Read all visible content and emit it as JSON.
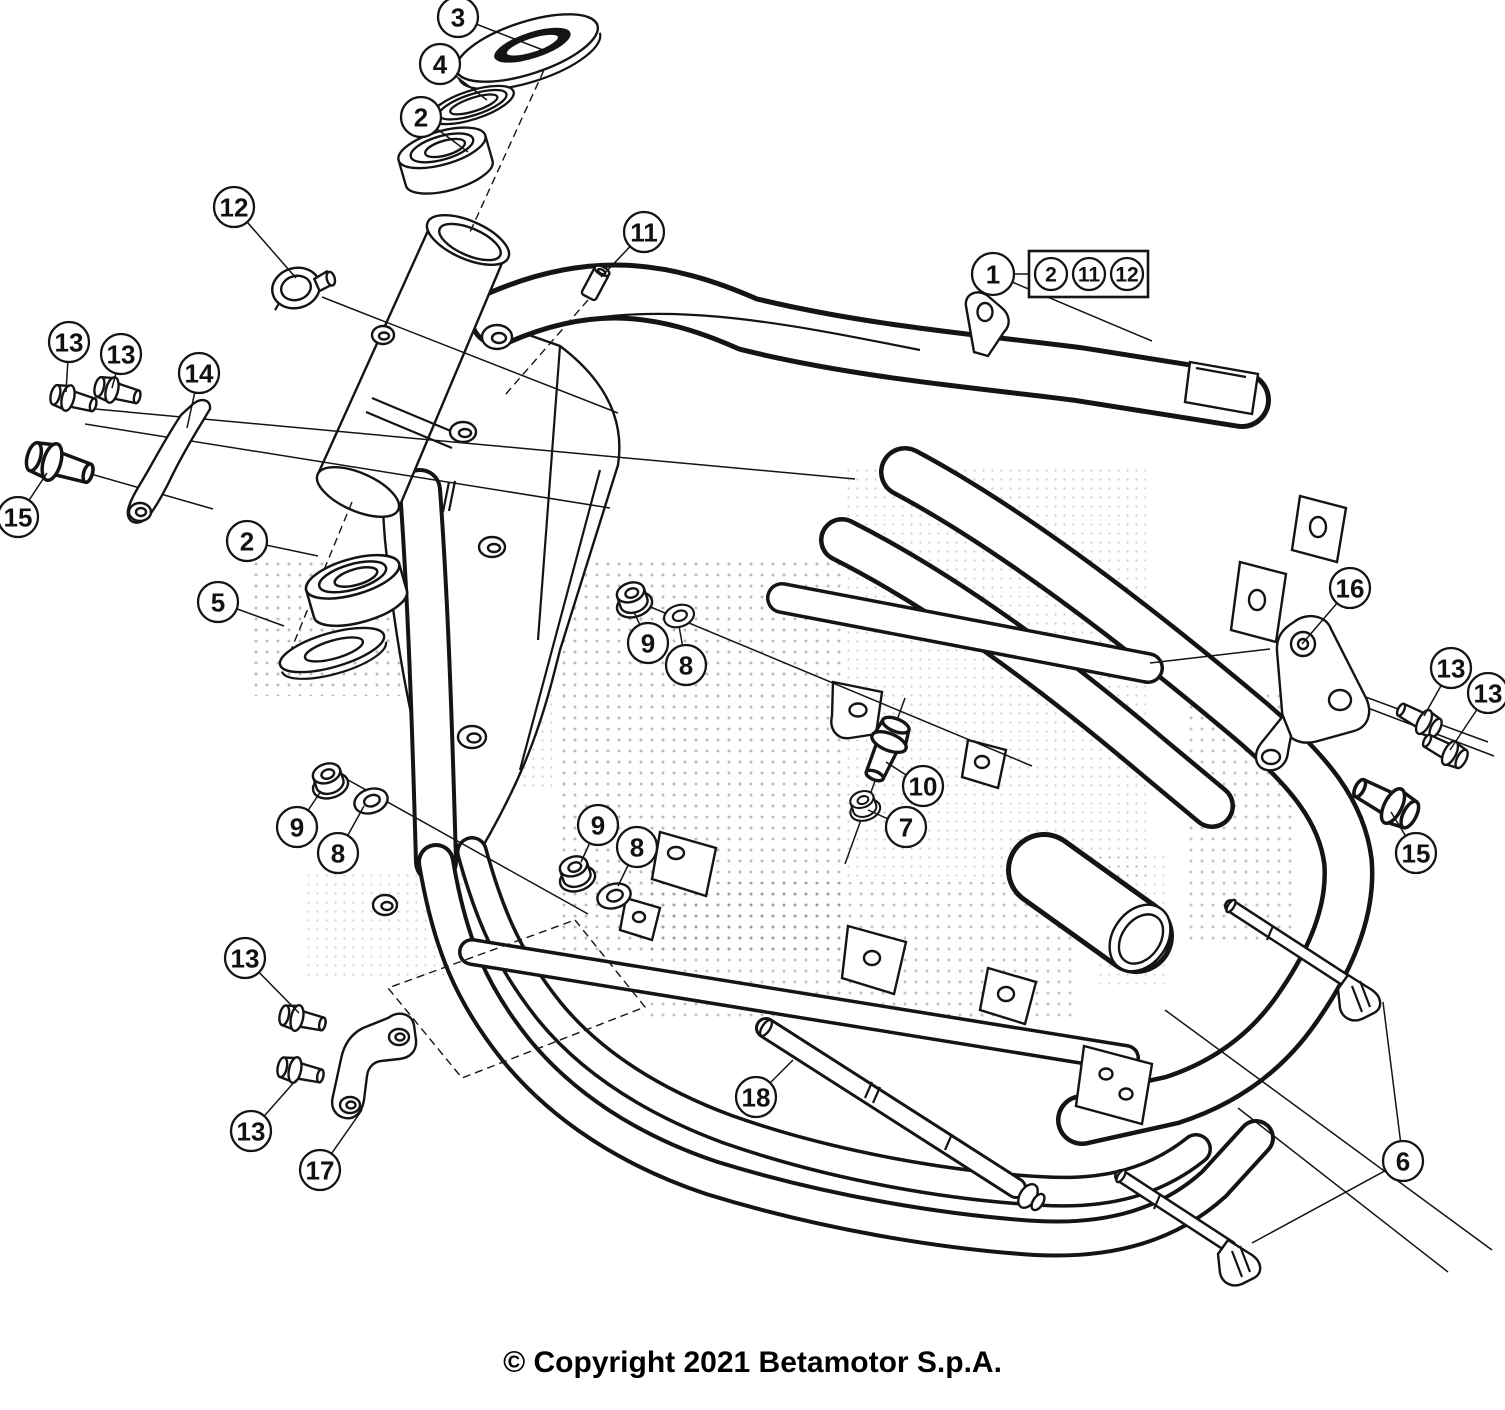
{
  "diagram": {
    "footer": {
      "copyright": "© Copyright 2021 Betamotor S.p.A."
    },
    "colors": {
      "line": "#141414",
      "background": "#ffffff",
      "halftone": "#80868d"
    },
    "bubble": {
      "radius": 20,
      "font_size": 26
    },
    "legend_box": {
      "lead": {
        "label": "1",
        "x": 993,
        "y": 274,
        "r": 21,
        "targets": [
          [
            1152,
            341
          ]
        ]
      },
      "connector": [
        1014,
        274,
        1029,
        274
      ],
      "box": {
        "x": 1029,
        "y": 251,
        "w": 119,
        "h": 46
      },
      "item_radius": 16,
      "item_font_size": 21,
      "items": [
        {
          "label": "2",
          "cx": 1051,
          "cy": 274
        },
        {
          "label": "11",
          "cx": 1089,
          "cy": 274
        },
        {
          "label": "12",
          "cx": 1127,
          "cy": 274
        }
      ]
    },
    "callouts": [
      {
        "label": "3",
        "x": 458,
        "y": 17,
        "targets": [
          [
            543,
            50
          ]
        ]
      },
      {
        "label": "4",
        "x": 440,
        "y": 64,
        "targets": [
          [
            487,
            100
          ]
        ]
      },
      {
        "label": "2",
        "x": 421,
        "y": 117,
        "targets": [
          [
            468,
            152
          ]
        ]
      },
      {
        "label": "12",
        "x": 234,
        "y": 207,
        "targets": [
          [
            296,
            278
          ]
        ]
      },
      {
        "label": "11",
        "x": 644,
        "y": 232,
        "targets": [
          [
            601,
            277
          ]
        ]
      },
      {
        "label": "13",
        "x": 69,
        "y": 342,
        "targets": [
          [
            66,
            392
          ]
        ]
      },
      {
        "label": "13",
        "x": 121,
        "y": 354,
        "targets": [
          [
            112,
            388
          ]
        ]
      },
      {
        "label": "14",
        "x": 199,
        "y": 373,
        "targets": [
          [
            187,
            428
          ]
        ]
      },
      {
        "label": "15",
        "x": 18,
        "y": 517,
        "targets": [
          [
            47,
            473
          ]
        ]
      },
      {
        "label": "2",
        "x": 247,
        "y": 541,
        "targets": [
          [
            318,
            556
          ]
        ]
      },
      {
        "label": "5",
        "x": 218,
        "y": 602,
        "targets": [
          [
            284,
            626
          ]
        ]
      },
      {
        "label": "9",
        "x": 648,
        "y": 643,
        "targets": [
          [
            634,
            612
          ]
        ]
      },
      {
        "label": "8",
        "x": 686,
        "y": 665,
        "targets": [
          [
            679,
            626
          ]
        ]
      },
      {
        "label": "16",
        "x": 1350,
        "y": 588,
        "targets": [
          [
            1302,
            644
          ]
        ]
      },
      {
        "label": "13",
        "x": 1451,
        "y": 668,
        "targets": [
          [
            1424,
            716
          ]
        ]
      },
      {
        "label": "13",
        "x": 1488,
        "y": 693,
        "targets": [
          [
            1450,
            750
          ]
        ]
      },
      {
        "label": "10",
        "x": 923,
        "y": 786,
        "targets": [
          [
            886,
            762
          ]
        ]
      },
      {
        "label": "7",
        "x": 906,
        "y": 827,
        "targets": [
          [
            868,
            810
          ]
        ]
      },
      {
        "label": "9",
        "x": 297,
        "y": 827,
        "targets": [
          [
            321,
            791
          ]
        ]
      },
      {
        "label": "8",
        "x": 338,
        "y": 853,
        "targets": [
          [
            364,
            806
          ]
        ]
      },
      {
        "label": "9",
        "x": 598,
        "y": 825,
        "targets": [
          [
            581,
            862
          ]
        ]
      },
      {
        "label": "8",
        "x": 637,
        "y": 847,
        "targets": [
          [
            618,
            886
          ]
        ]
      },
      {
        "label": "15",
        "x": 1416,
        "y": 853,
        "targets": [
          [
            1391,
            812
          ]
        ]
      },
      {
        "label": "13",
        "x": 245,
        "y": 958,
        "targets": [
          [
            299,
            1013
          ]
        ]
      },
      {
        "label": "13",
        "x": 251,
        "y": 1131,
        "targets": [
          [
            296,
            1080
          ]
        ]
      },
      {
        "label": "17",
        "x": 320,
        "y": 1170,
        "targets": [
          [
            362,
            1110
          ]
        ]
      },
      {
        "label": "18",
        "x": 756,
        "y": 1097,
        "targets": [
          [
            793,
            1060
          ]
        ]
      },
      {
        "label": "6",
        "x": 1403,
        "y": 1161,
        "targets": [
          [
            1383,
            1002
          ],
          [
            1252,
            1243
          ]
        ]
      }
    ]
  }
}
